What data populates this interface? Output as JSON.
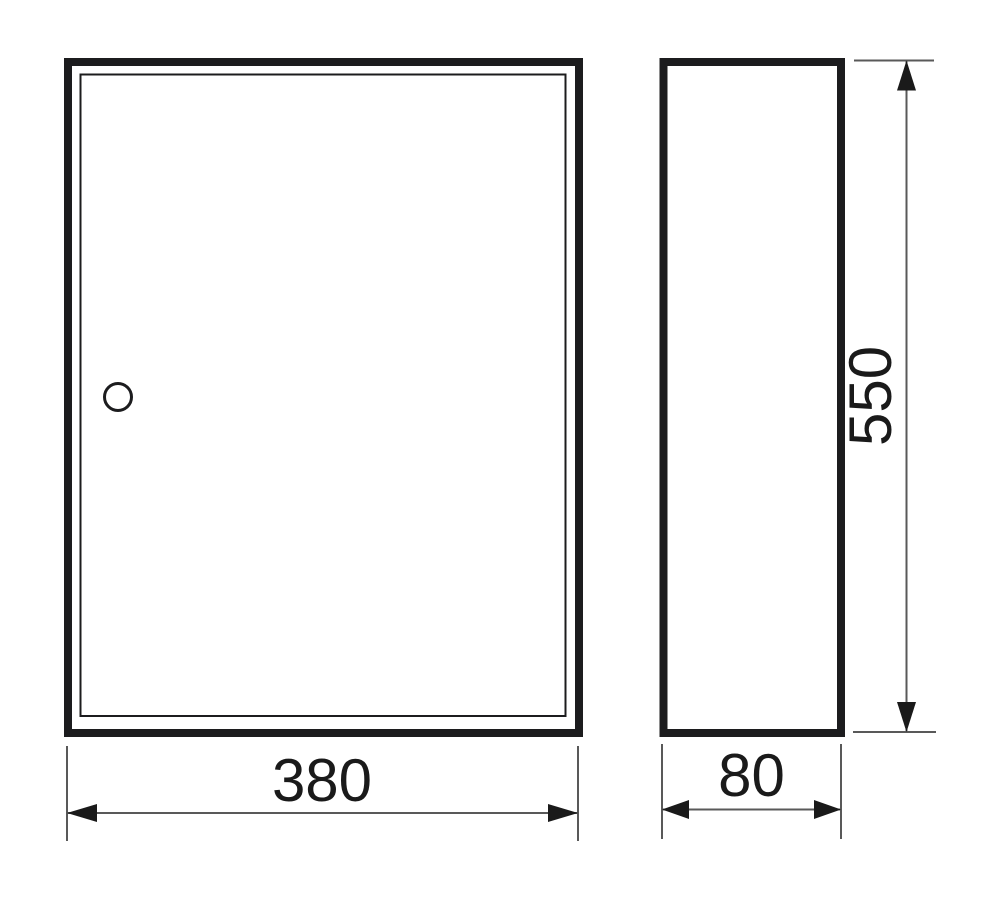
{
  "drawing": {
    "type": "technical-dimension-drawing",
    "views": {
      "front": {
        "features": [
          "outer-body",
          "door-panel",
          "lock-cylinder"
        ]
      },
      "side": {
        "features": [
          "outer-body"
        ]
      }
    },
    "dimensions": {
      "width": {
        "value": "380"
      },
      "depth": {
        "value": "80"
      },
      "height": {
        "value": "550"
      }
    },
    "colors": {
      "background": "#ffffff",
      "outline": "#1c1c1e",
      "dimension_line": "#595959",
      "text": "#1a1a1a"
    }
  }
}
